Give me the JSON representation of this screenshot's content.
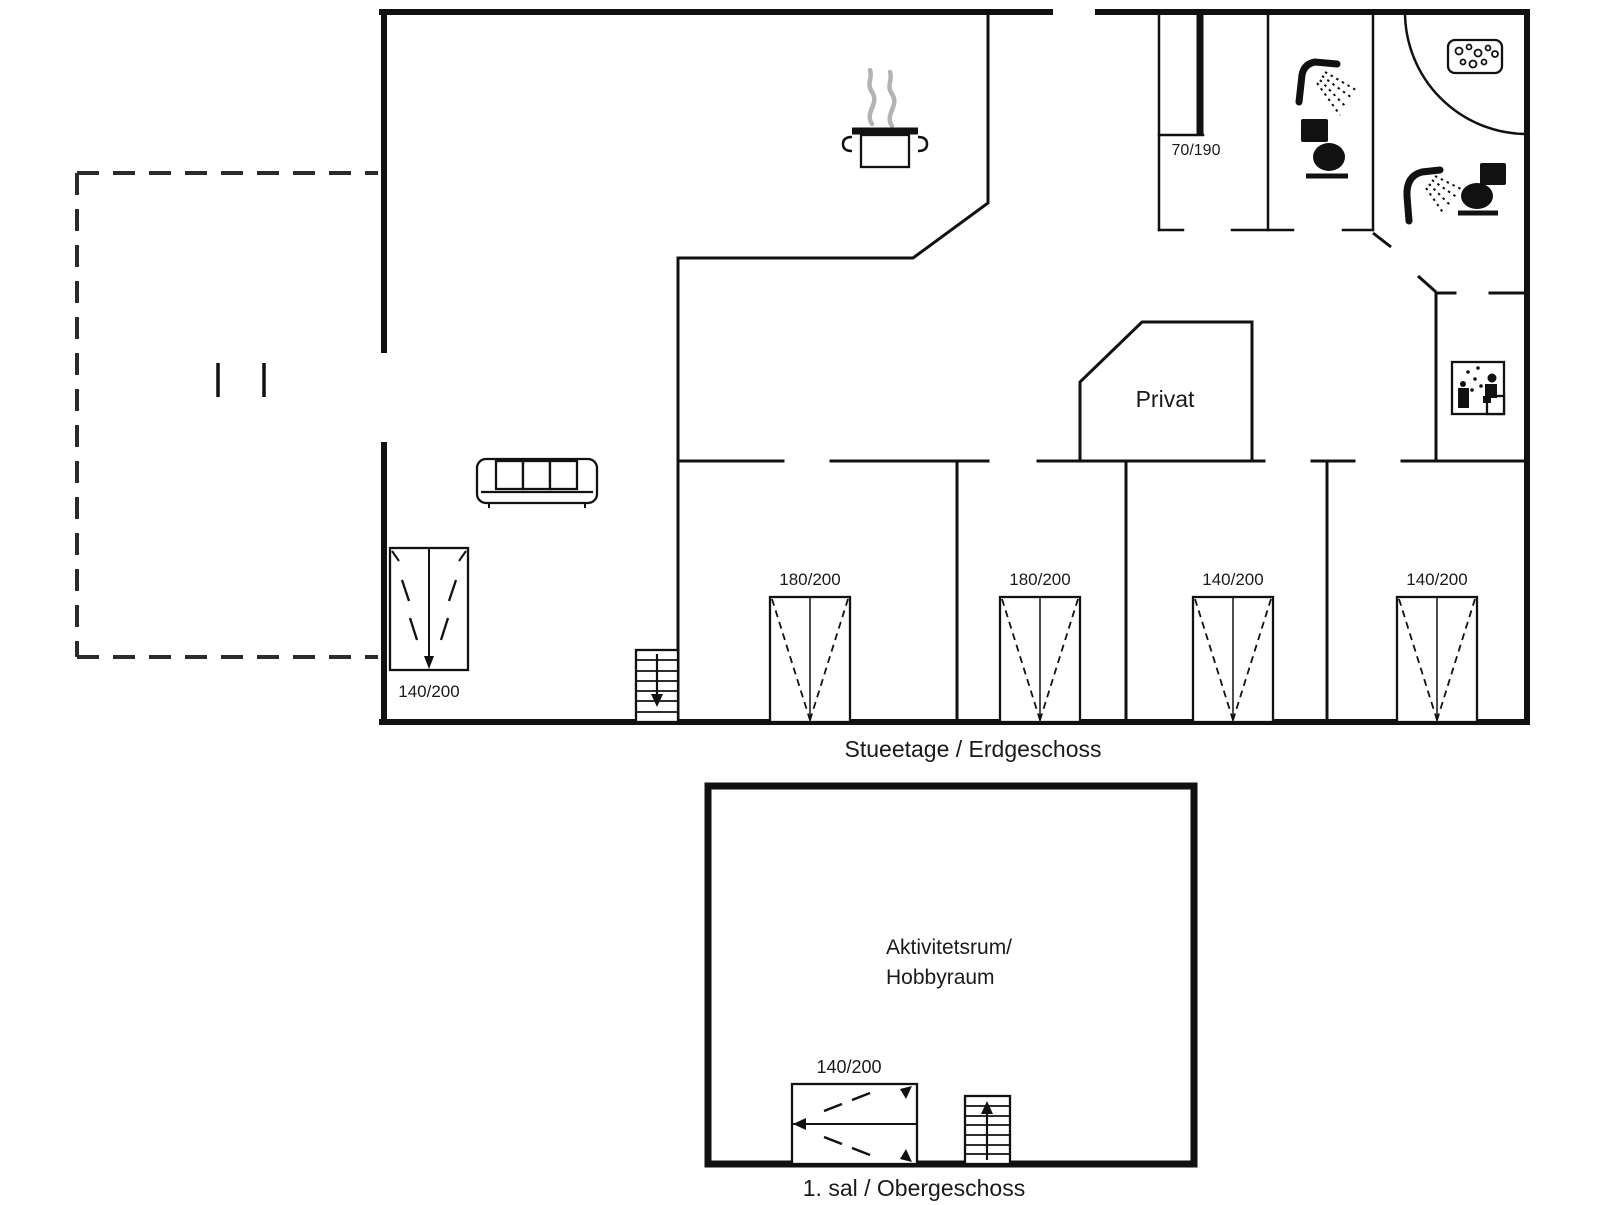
{
  "ground_floor": {
    "caption": "Stueetage / Erdgeschoss",
    "private_room_label": "Privat",
    "shower_dim": "70/190",
    "wardrobe_dim": "140/200",
    "bed_dims": [
      "180/200",
      "180/200",
      "140/200",
      "140/200"
    ]
  },
  "first_floor": {
    "caption": "1. sal / Obergeschoss",
    "room_name_line1": "Aktivitetsrum/",
    "room_name_line2": "Hobbyraum",
    "bed_dim": "140/200"
  },
  "icons": {
    "cooking_pot": "cooking-pot-with-steam",
    "sofa": "three-seat-sofa",
    "wardrobe": "wardrobe-with-opening-arrow",
    "stairs_down": "stairs-arrow-down",
    "stairs_up": "stairs-arrow-up",
    "bed": "double-bed-top-view",
    "shower": "shower-head-with-spray",
    "toilet": "toilet-silhouette",
    "washbasin": "basin-with-bubbles",
    "washing_machine": "washing-machine-pictogram",
    "terrace": "dashed-terrace-outline",
    "door_swing": "quarter-circle-door-swing"
  },
  "colors": {
    "wall": "#111111",
    "steam": "#b3b3b3",
    "text": "#1a1a1a",
    "background": "#ffffff"
  }
}
